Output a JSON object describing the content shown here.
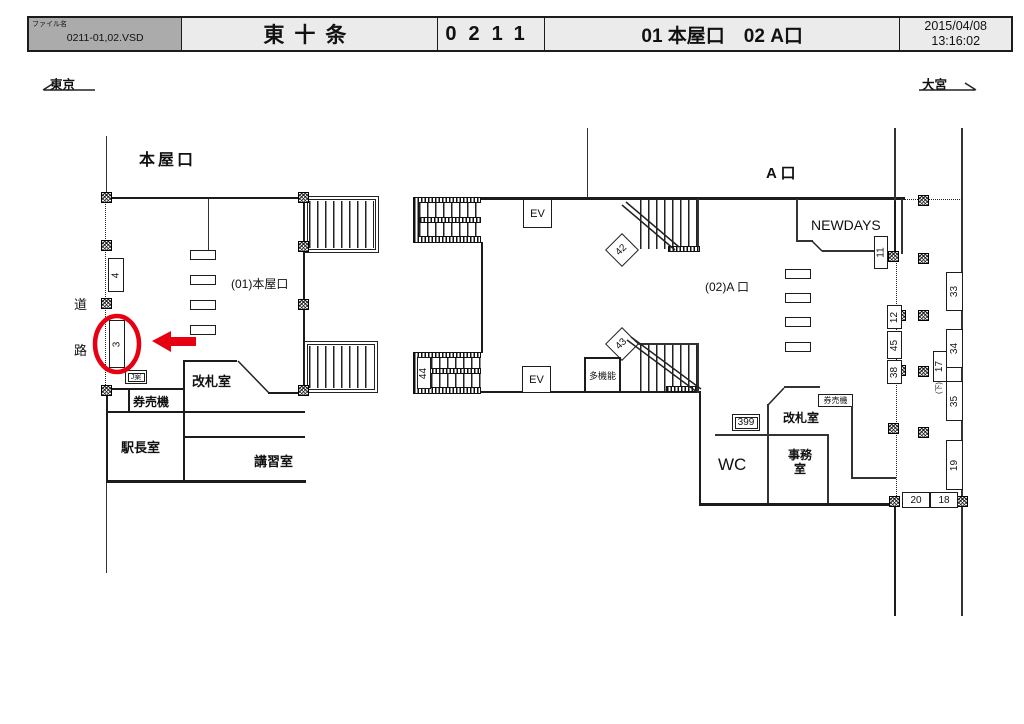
{
  "header": {
    "file_label": "ファイル名",
    "file_name": "0211-01,02.VSD",
    "station_name": "東十条",
    "station_code": "0211",
    "entrance_list": "01 本屋口　02 A口",
    "date": "2015/04/08",
    "time": "13:16:02"
  },
  "directions": {
    "left": "東京",
    "right": "大宮"
  },
  "areas": {
    "left_title": "本屋口",
    "left_area": "(01)本屋口",
    "right_title": "A 口",
    "right_area": "(02)A 口",
    "road_1": "道",
    "road_2": "路",
    "newdays": "NEWDAYS",
    "wc": "WC"
  },
  "rooms": {
    "left_kaisatsu": "改札室",
    "left_kenbaiki": "券売機",
    "ekichoshitsu": "駅長室",
    "koshushitsu": "講習室",
    "j_sign": "J案",
    "right_kaisatsu": "改札室",
    "right_kenbaiki": "券売機",
    "jimu_line1": "事務",
    "jimu_line2": "室",
    "takinou": "多機能",
    "ev": "EV"
  },
  "markers": {
    "m3": "3",
    "m4": "4",
    "m11": "11",
    "m12": "12",
    "m17": "17",
    "m17_note": "(下)",
    "m18": "18",
    "m19": "19",
    "m20": "20",
    "m33": "33",
    "m34": "34",
    "m35": "35",
    "m38": "38",
    "m42": "42",
    "m43": "43",
    "m44": "44",
    "m45": "45",
    "m399": "399"
  },
  "colors": {
    "accent_red": "#e60012",
    "header_fill_dark": "#ababab",
    "header_fill_light": "#ebebeb",
    "line_color": "#1c1c1c"
  }
}
